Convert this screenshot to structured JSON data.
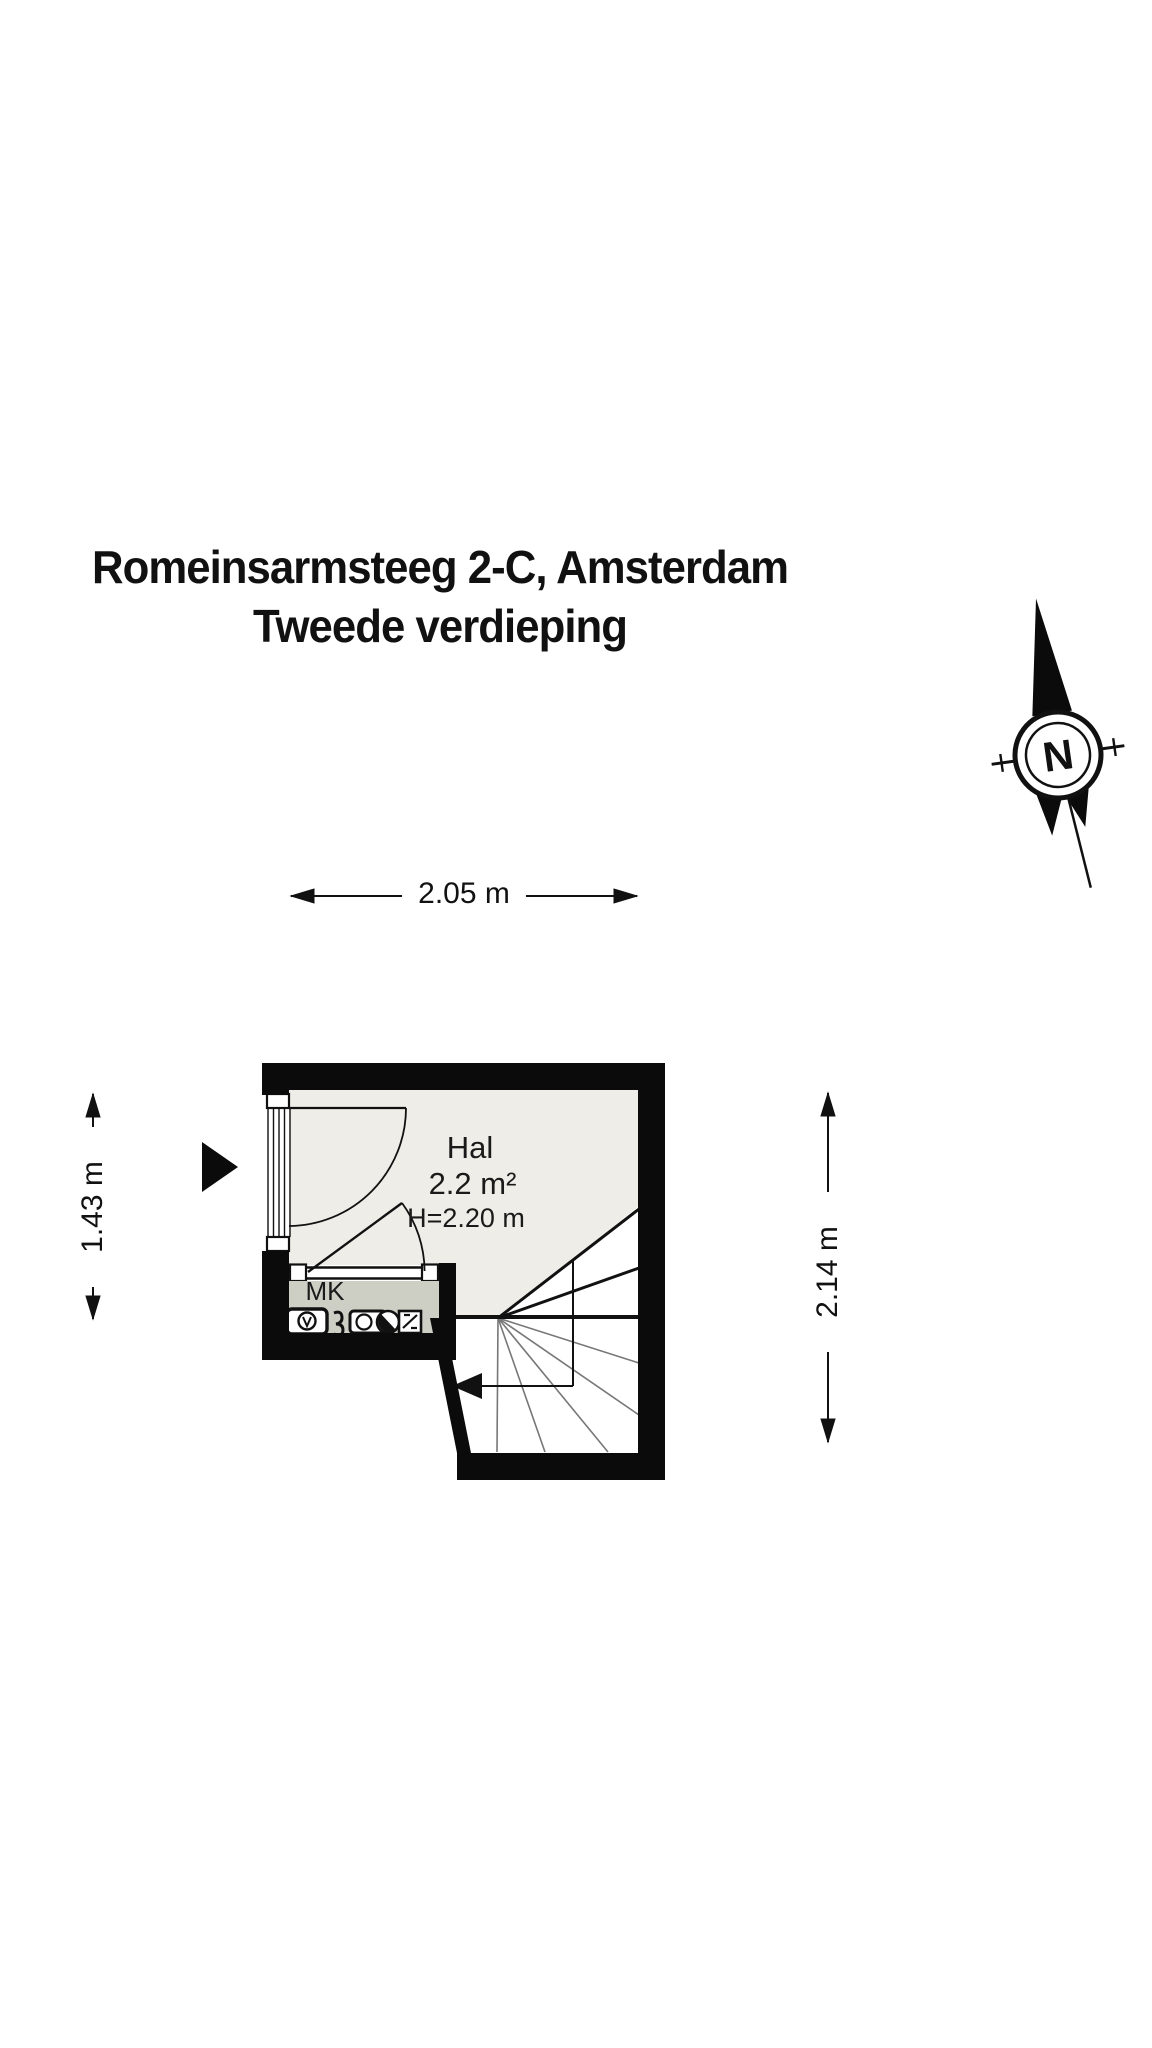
{
  "title": {
    "line1": "Romeinsarmsteeg 2-C, Amsterdam",
    "line2": "Tweede verdieping"
  },
  "compass": {
    "label": "N"
  },
  "dimensions": {
    "top": "2.05 m",
    "left": "1.43 m",
    "right": "2.14 m"
  },
  "rooms": {
    "hal": {
      "name": "Hal",
      "area": "2.2 m²",
      "height": "H=2.20 m"
    },
    "mk": {
      "name": "MK",
      "icons": [
        "gas-meter",
        "electricity-meter",
        "water-meter",
        "heater-unit"
      ]
    }
  },
  "plan_features": [
    "entrance-arrow",
    "entry-door-with-swing",
    "window-in-left-wall",
    "interior-door-to-mk",
    "winder-staircase-with-down-arrow",
    "north-compass"
  ],
  "colors": {
    "wall": "#0b0b0b",
    "hal_floor": "#eeede7",
    "mk_floor": "#cdcec4",
    "line": "#111111",
    "tread_line": "#777777",
    "bg": "#ffffff"
  }
}
